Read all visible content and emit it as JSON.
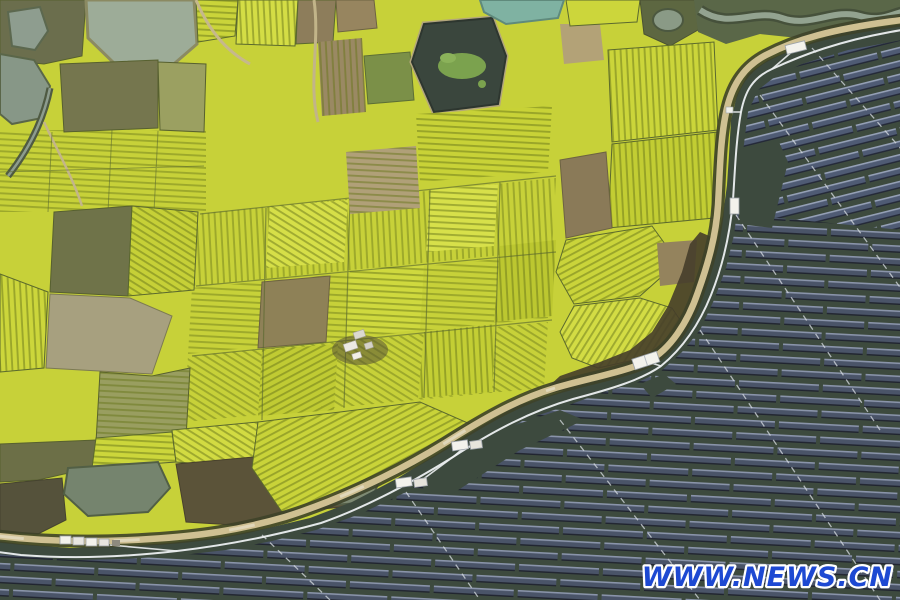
{
  "watermark": {
    "text": "WWW.NEWS.CN",
    "color": "#1d49d2",
    "outline_color": "#ffffff"
  },
  "scene": {
    "type": "aerial-photograph",
    "subjects": [
      "rapeseed flower fields in bloom",
      "floating solar photovoltaaic array on pond water",
      "curving dirt field road",
      "irrigation ponds",
      "white service platforms and sheds"
    ],
    "palette": {
      "rapeseed_yellow": "#c7d139",
      "field_olive": "#6f7349",
      "field_brown": "#8d7d5b",
      "pond_gray_green": "#9dac98",
      "solar_water": "#3d4a3e",
      "solar_panel": "#4a5468",
      "road_tan": "#cfc092",
      "walkway_white": "#eceff1"
    }
  }
}
